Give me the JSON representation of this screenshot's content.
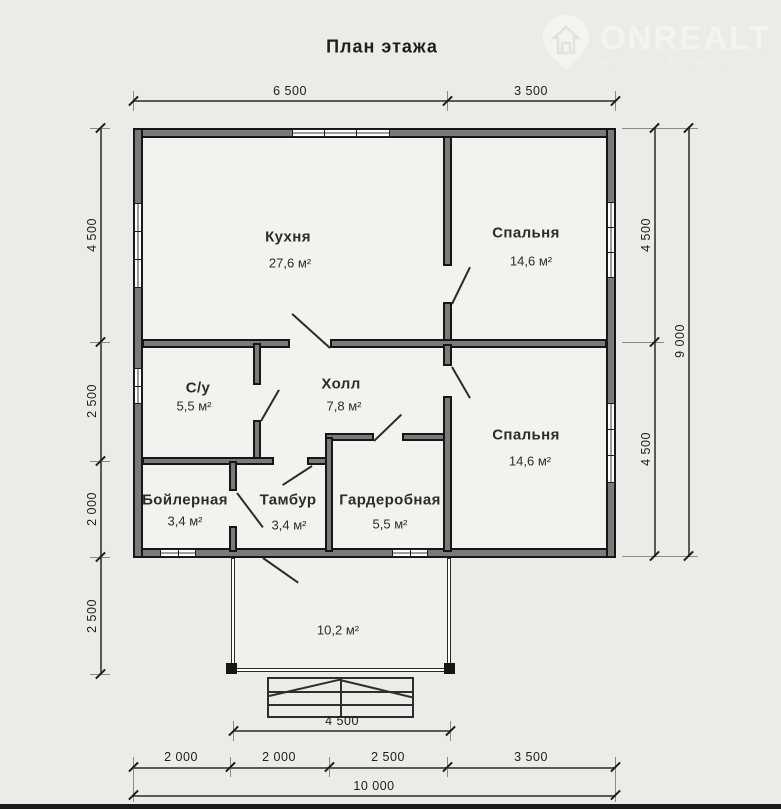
{
  "title": "План этажа",
  "watermark": {
    "brand": "ONREALT",
    "subtitle": "НЕДВИЖИМОСТЬ",
    "icon": "house-pin-icon"
  },
  "rooms": [
    {
      "name": "Кухня",
      "area": "27,6 м²"
    },
    {
      "name": "Спальня",
      "area": "14,6 м²"
    },
    {
      "name": "С/у",
      "area": "5,5 м²"
    },
    {
      "name": "Холл",
      "area": "7,8 м²"
    },
    {
      "name": "Спальня",
      "area": "14,6 м²"
    },
    {
      "name": "Бойлерная",
      "area": "3,4 м²"
    },
    {
      "name": "Тамбур",
      "area": "3,4 м²"
    },
    {
      "name": "Гардеробная",
      "area": "5,5 м²"
    }
  ],
  "porch": {
    "area": "10,2 м²"
  },
  "dimensions": {
    "top": [
      "6 500",
      "3 500"
    ],
    "left": [
      "4 500",
      "2 500",
      "2 000",
      "2 500"
    ],
    "right_inner": [
      "4 500",
      "4 500"
    ],
    "right_total": "9 000",
    "bottom": [
      "2 000",
      "2 000",
      "2 500",
      "3 500"
    ],
    "bottom_total": "10 000",
    "porch_width": "4 500"
  },
  "colors": {
    "background": "#edebe8",
    "wall": "#161616",
    "dimension_text": "#1d1d1d"
  }
}
